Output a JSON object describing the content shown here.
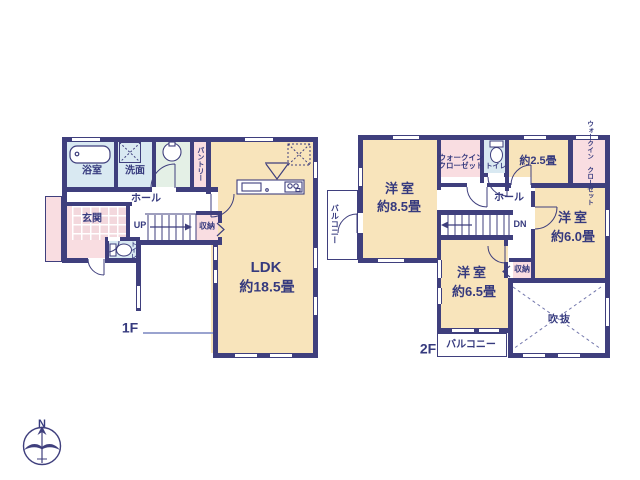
{
  "colors": {
    "wall": "#3f3f7d",
    "room_cream": "#f8e4bb",
    "room_pink": "#f9dde1",
    "room_blue": "#d9e9f2",
    "room_green": "#e4f0e6",
    "text_navy": "#363a7e"
  },
  "compass": {
    "north_label": "N"
  },
  "f1": {
    "floor_label": "1F",
    "bath": "浴室",
    "washroom": "洗面",
    "pantry": "パントリー",
    "hall": "ホール",
    "up": "UP",
    "storage": "収納",
    "entrance": "玄関",
    "toilet": "トイレ",
    "ldk_name": "LDK",
    "ldk_size": "約18.5畳"
  },
  "f2": {
    "floor_label": "2F",
    "balcony_left": "バルコニー",
    "bedroom85_name": "洋室",
    "bedroom85_size": "約8.5畳",
    "wic_line1": "ウォークイン",
    "wic_line2": "クローゼット",
    "toilet": "トイレ",
    "room25_size": "約2.5畳",
    "wic_right_line1": "ウォークイン",
    "wic_right_line2": "クローゼット",
    "hall": "ホール",
    "dn": "DN",
    "bedroom60_name": "洋室",
    "bedroom60_size": "約6.0畳",
    "bedroom65_name": "洋室",
    "bedroom65_size": "約6.5畳",
    "storage": "収納",
    "void": "吹抜",
    "balcony_bottom": "バルコニー"
  }
}
